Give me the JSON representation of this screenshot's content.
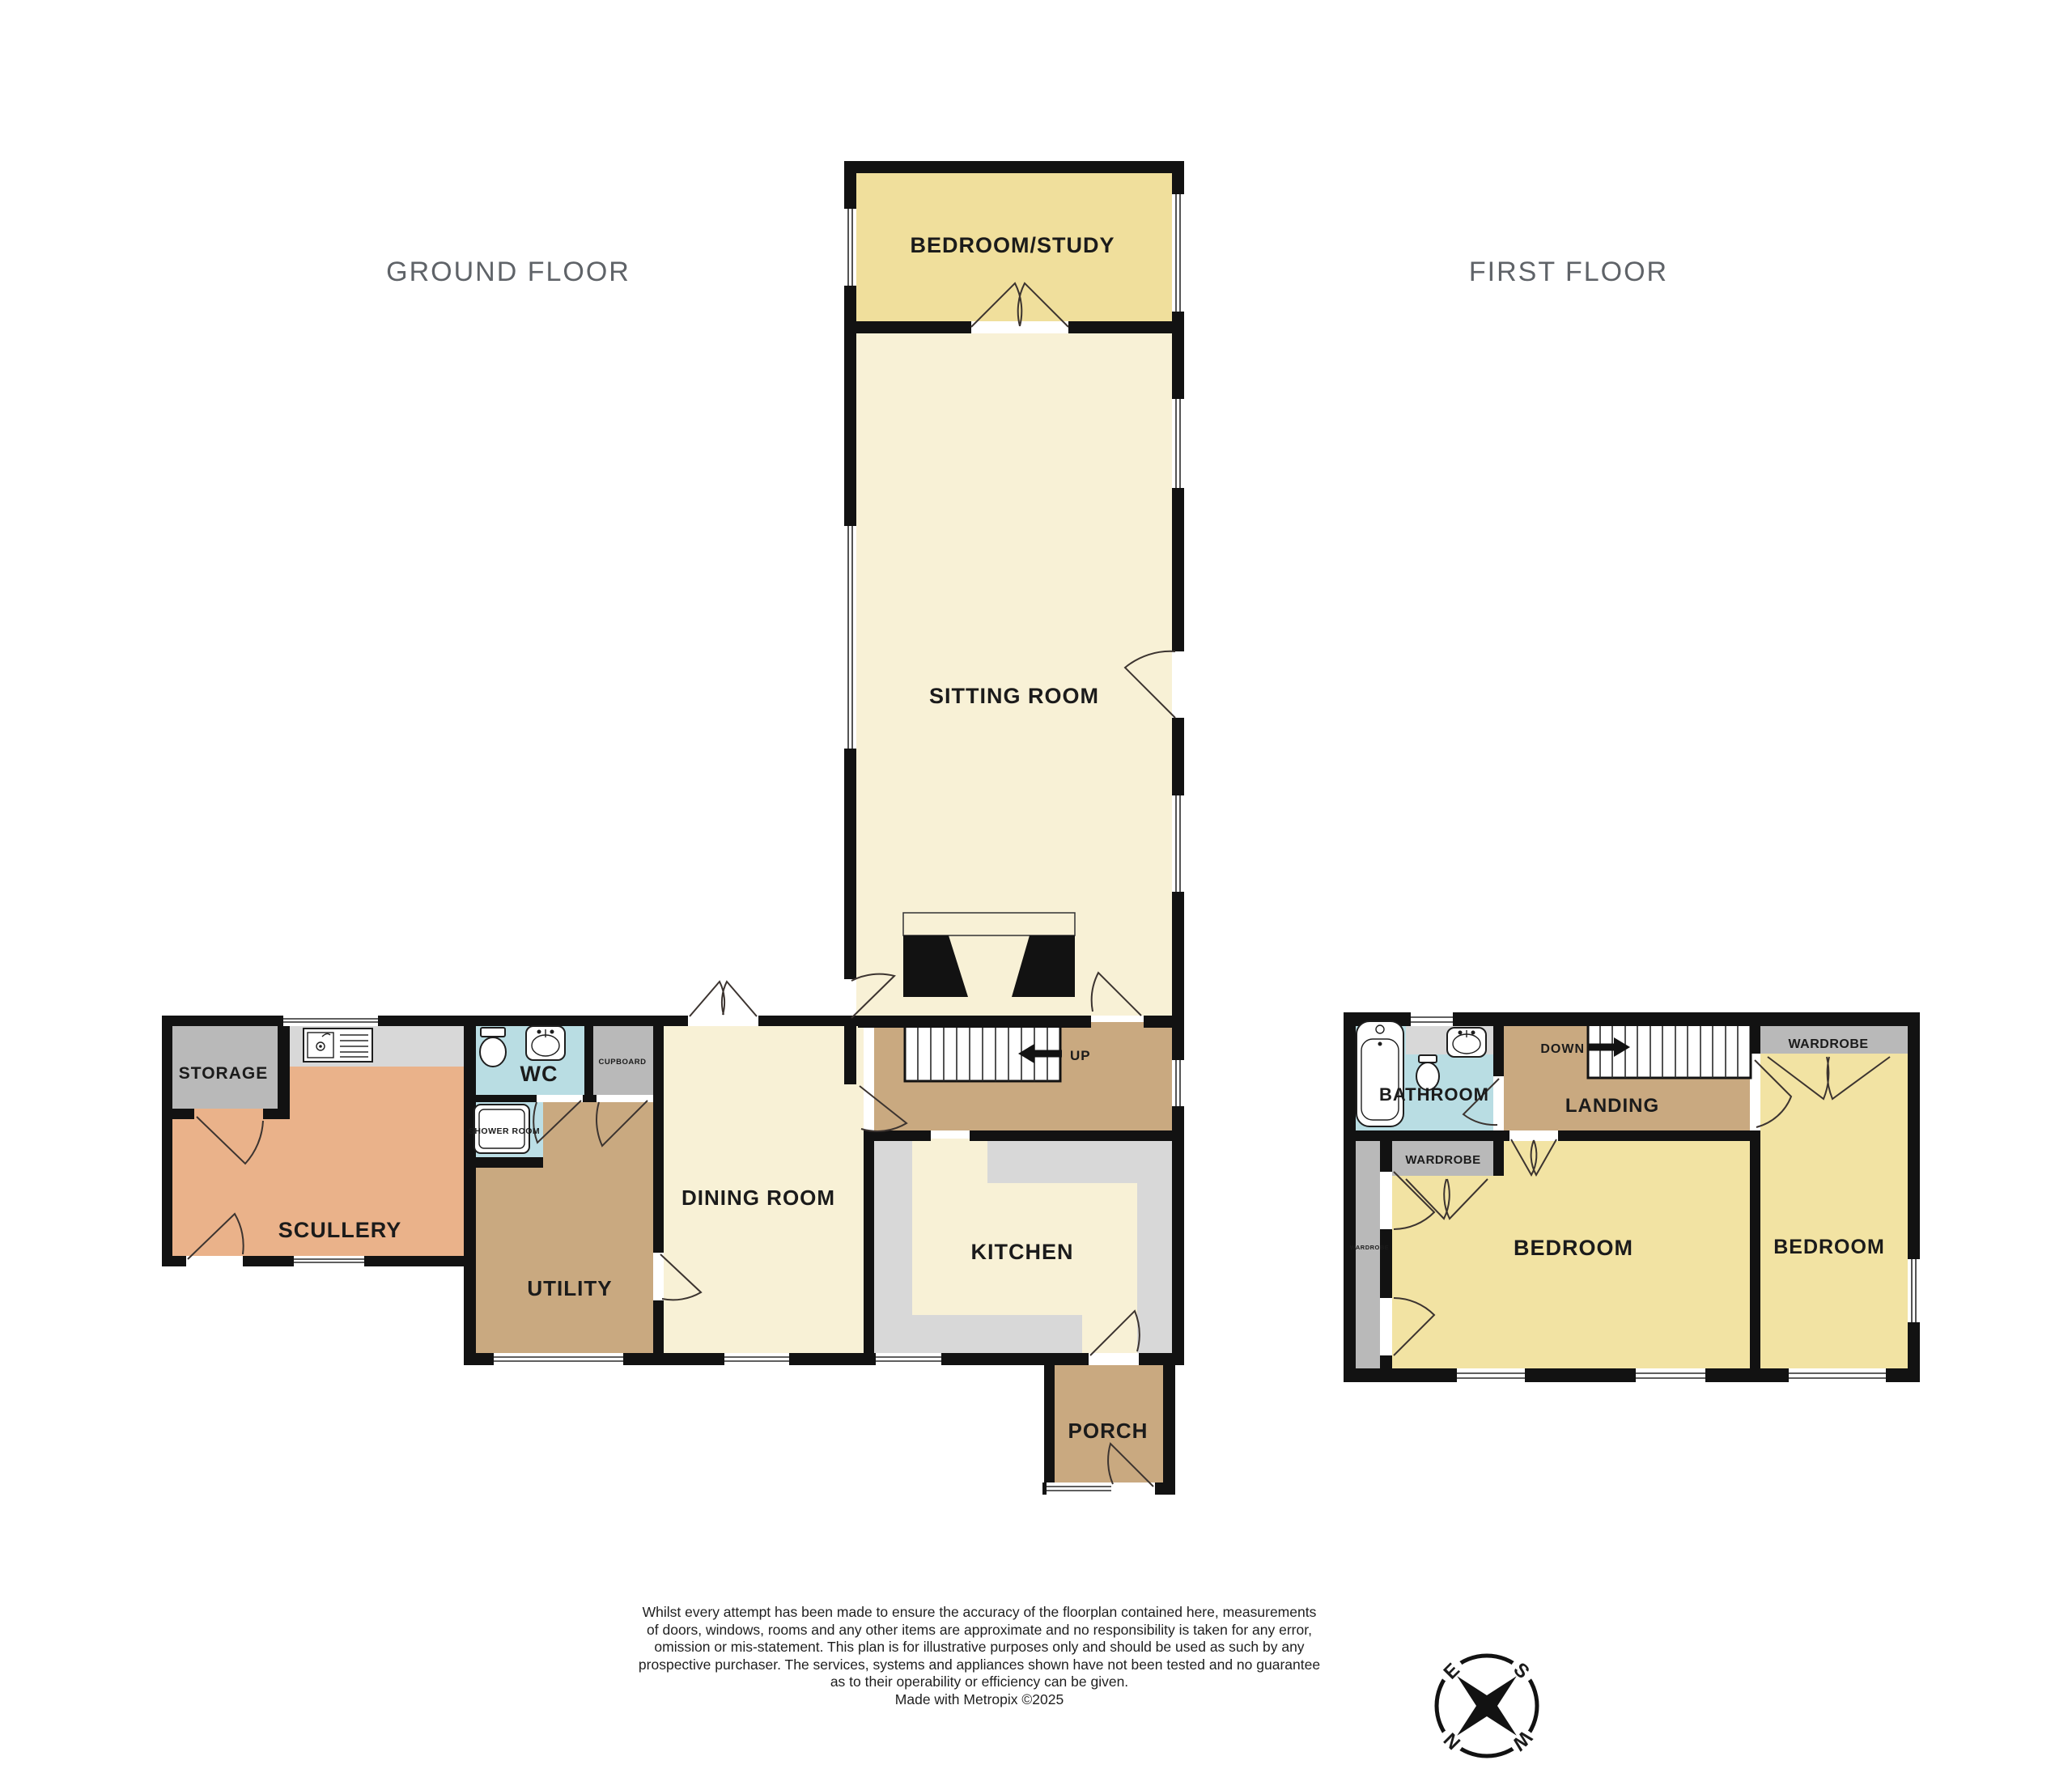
{
  "titles": {
    "ground": "GROUND FLOOR",
    "first": "FIRST FLOOR"
  },
  "ground_floor": {
    "bedroom_study": "BEDROOM/STUDY",
    "sitting_room": "SITTING ROOM",
    "up": "UP",
    "storage": "STORAGE",
    "scullery": "SCULLERY",
    "wc": "WC",
    "cupboard": "CUPBOARD",
    "shower_room": "SHOWER ROOM",
    "utility": "UTILITY",
    "dining_room": "DINING ROOM",
    "kitchen": "KITCHEN",
    "porch": "PORCH"
  },
  "first_floor": {
    "bathroom": "BATHROOM",
    "landing": "LANDING",
    "down": "DOWN",
    "wardrobe_top": "WARDROBE",
    "wardrobe_mid": "WARDROBE",
    "wardrobe_left": "WARDROBE",
    "bedroom_center": "BEDROOM",
    "bedroom_right": "BEDROOM"
  },
  "compass": {
    "n": "N",
    "e": "E",
    "s": "S",
    "w": "W"
  },
  "disclaimer": {
    "lines": [
      "Whilst every attempt has been made to ensure the accuracy of the floorplan contained here, measurements",
      "of doors, windows, rooms and any other items are approximate and no responsibility is taken for any error,",
      "omission or mis-statement. This plan is for illustrative purposes only and should be used as such by any",
      "prospective purchaser. The services, systems and appliances shown have not been tested and no guarantee",
      "as to their operability or efficiency can be given.",
      "Made with Metropix ©2025"
    ]
  },
  "colors": {
    "wall": "#121212",
    "cream_room": "#f8f1d6",
    "yellow_room": "#f0df9c",
    "tan_room": "#c9a980",
    "orange_room": "#eab28a",
    "blue_room": "#b9dde3",
    "gray_room": "#b9b9b9",
    "counter": "#d8d8d8",
    "title_text": "#5f6368"
  }
}
